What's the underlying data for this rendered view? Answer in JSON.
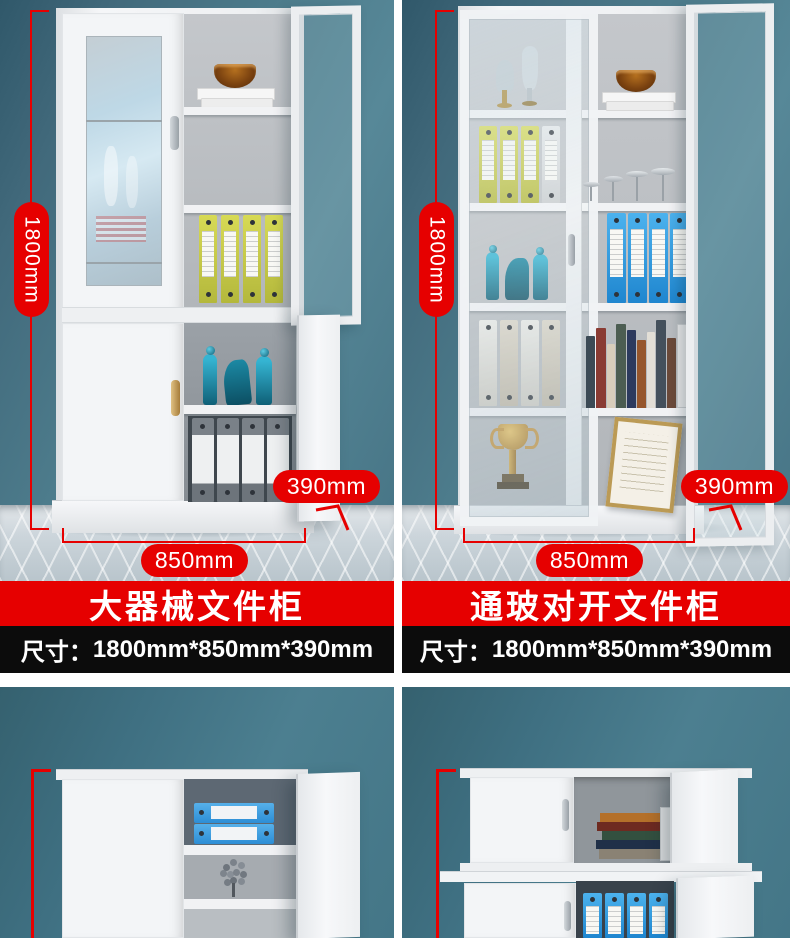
{
  "page": {
    "type": "e-commerce product detail composite",
    "background": "#ffffff"
  },
  "colors": {
    "accent_red": "#e60000",
    "banner_black": "#0c0c0c",
    "wall_teal": "#4d7c8c",
    "floor_tile": "#ccd4da",
    "cabinet_white": "#f3f5f7",
    "binder_yellow": "#ccd14e",
    "binder_blue": "#2f9fe5",
    "text_white": "#ffffff"
  },
  "top_products": [
    {
      "title": "大器械文件柜",
      "size_label": "尺寸：",
      "size_value": "1800mm*850mm*390mm",
      "dims": {
        "height": "1800mm",
        "width": "850mm",
        "depth": "390mm"
      }
    },
    {
      "title": "通玻对开文件柜",
      "size_label": "尺寸：",
      "size_value": "1800mm*850mm*390mm",
      "dims": {
        "height": "1800mm",
        "width": "850mm",
        "depth": "390mm"
      }
    }
  ]
}
